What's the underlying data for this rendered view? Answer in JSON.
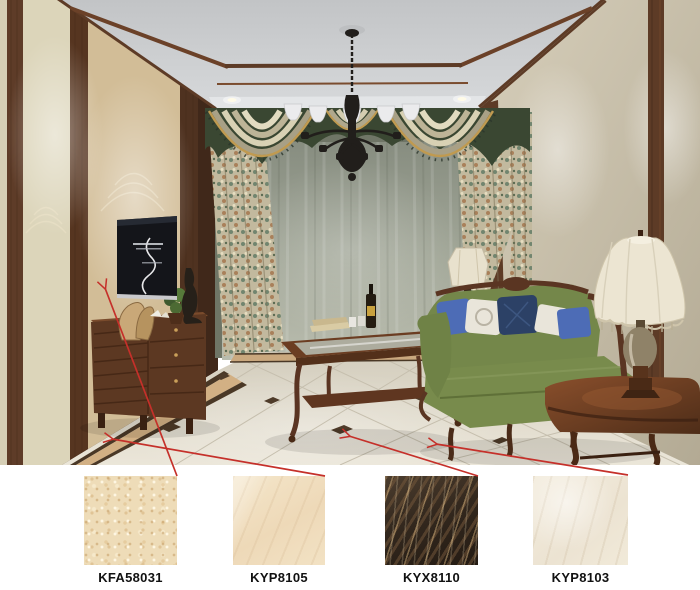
{
  "page": {
    "background": "#ffffff"
  },
  "tiles": [
    {
      "code": "KFA58031",
      "base_color": "#eedcb8"
    },
    {
      "code": "KYP8105",
      "base_color": "#f0debf"
    },
    {
      "code": "KYX8110",
      "base_color": "#342a20"
    },
    {
      "code": "KYP8103",
      "base_color": "#f1ebde"
    }
  ],
  "annotations": {
    "arrow_color": "#c5302a",
    "arrows": [
      {
        "tile": "KFA58031",
        "from": [
          177,
          476
        ],
        "to": [
          105,
          288
        ]
      },
      {
        "tile": "KYP8105",
        "from": [
          325,
          476
        ],
        "to": [
          112,
          439
        ]
      },
      {
        "tile": "KYX8110",
        "from": [
          478,
          476
        ],
        "to": [
          349,
          436
        ]
      },
      {
        "tile": "KYP8103",
        "from": [
          628,
          475
        ],
        "to": [
          436,
          444
        ]
      }
    ]
  },
  "room_palette": {
    "ceiling": "#c9cbcd",
    "wood_trim": "#5d3b26",
    "left_wall_marble": "#d9cfae",
    "tv_panel_marble": "#d2bd97",
    "right_wall": "#cdc4ae",
    "curtain_green": "#3d4a34",
    "sheer_curtain": "#a3a89a",
    "sofa_green": "#7b8e4e",
    "pillow_blue": "#4d6cb6",
    "pillow_navy": "#2c4166",
    "floor": "#e8e2d4",
    "floor_border_tan": "#d2b084",
    "floor_inset": "#4f3c2a",
    "furniture_wood": "#5d3a24",
    "lamp_shade": "#ece5d2",
    "chandelier": "#211e1b"
  }
}
